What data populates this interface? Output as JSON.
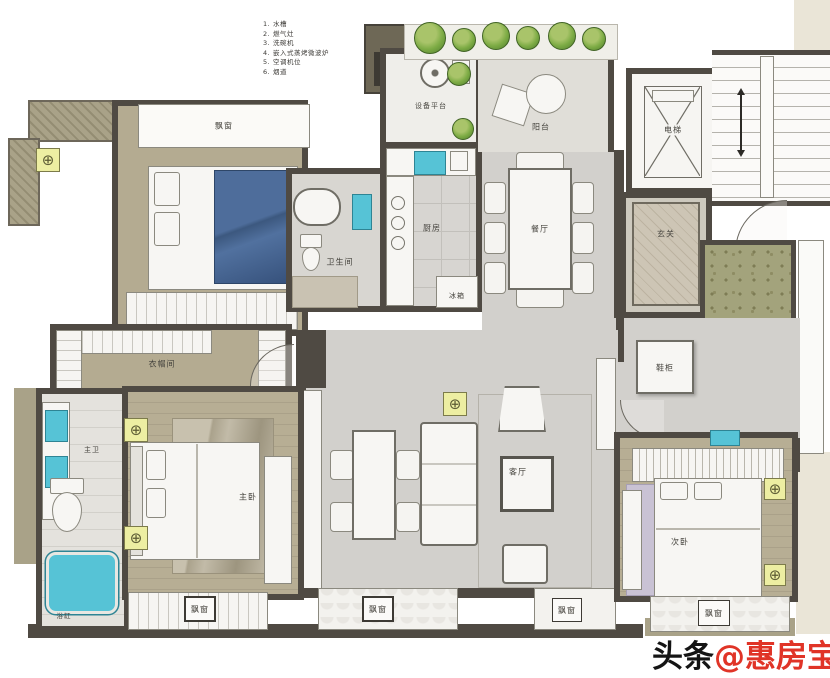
{
  "legend": {
    "items": [
      {
        "num": "1.",
        "label": "水槽"
      },
      {
        "num": "2.",
        "label": "燃气灶"
      },
      {
        "num": "3.",
        "label": "洗碗机"
      },
      {
        "num": "4.",
        "label": "嵌入式蒸烤微波炉"
      },
      {
        "num": "5.",
        "label": "空调机位"
      },
      {
        "num": "6.",
        "label": "烟道"
      }
    ]
  },
  "rooms": {
    "bay_window_top": "飘窗",
    "equipment": "设备平台",
    "balcony": "阳台",
    "kitchen": "厨房",
    "fridge": "冰箱",
    "dining": "餐厅",
    "elevator": "电梯",
    "foyer": "玄关",
    "bath_top": "卫生间",
    "closet": "衣帽间",
    "master_bath": "主卫",
    "master_bed": "主卧",
    "living": "客厅",
    "shoe_cabinet": "鞋柜",
    "bath_right": "卫生间",
    "bedroom2": "次卧",
    "bay_master": "飘窗",
    "bay_living1": "飘窗",
    "bay_living2": "飘窗",
    "bay_bed2": "飘窗",
    "tub": "浴缸"
  },
  "watermark": {
    "prefix": "头条",
    "handle": "@惠房宝"
  },
  "colors": {
    "wall": "#4f4a43",
    "floor_wood": "#b4ab91",
    "floor_gray": "#d2d0cc",
    "olive_surround": "#a9a288",
    "fixture_teal": "#56c3d6",
    "plant_green": "#7cab44",
    "symbol_yellow": "#edeea2",
    "bed_blue": "#4a6896",
    "rug_lavender": "#c9c2d4",
    "watermark_black": "#141414",
    "watermark_red": "#e03427"
  }
}
